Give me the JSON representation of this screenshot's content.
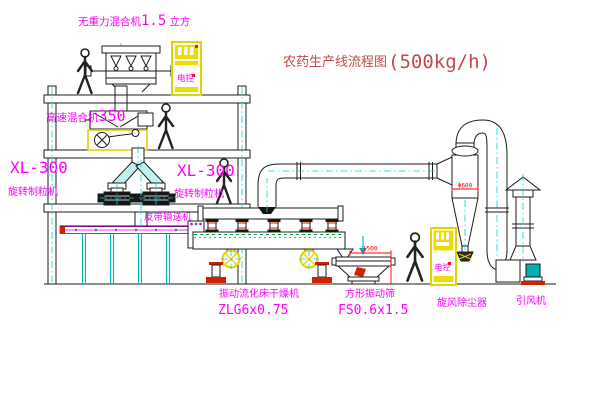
{
  "title": {
    "text": "农药生产线流程图",
    "capacity": "(500kg/h)"
  },
  "labels": {
    "gravity_mixer_name": "无重力混合机",
    "gravity_mixer_size": "1.5",
    "gravity_mixer_unit": "立方",
    "high_speed_mixer_name": "高速混合机",
    "high_speed_mixer_size": "350",
    "granulator_model_left": "XL-300",
    "granulator_name_left": "旋转制粒机",
    "granulator_model_right": "XL-300",
    "granulator_name_right": "旋转制粒机",
    "belt_conveyor": "皮带输送机",
    "dryer_name": "振动流化床干燥机",
    "dryer_model": "ZLG6x0.75",
    "sieve_name": "方形振动筛",
    "sieve_model": "FS0.6x1.5",
    "cyclone_name": "旋风除尘器",
    "fan_name": "引风机",
    "cabinet_label": "电控",
    "dim_dryer_length": "1500",
    "dim_cyclone_dia": "Φ600"
  },
  "colors": {
    "title_red": "#c24a4a",
    "label_magenta": "#ff00ff",
    "dimension_red": "#ff0000",
    "line_dark": "#1c1c1c",
    "centerline_cyan": "#00d8d8",
    "equipment_yellow": "#ecdc00",
    "base_red": "#cc2200",
    "motor_teal": "#00b0b0"
  }
}
